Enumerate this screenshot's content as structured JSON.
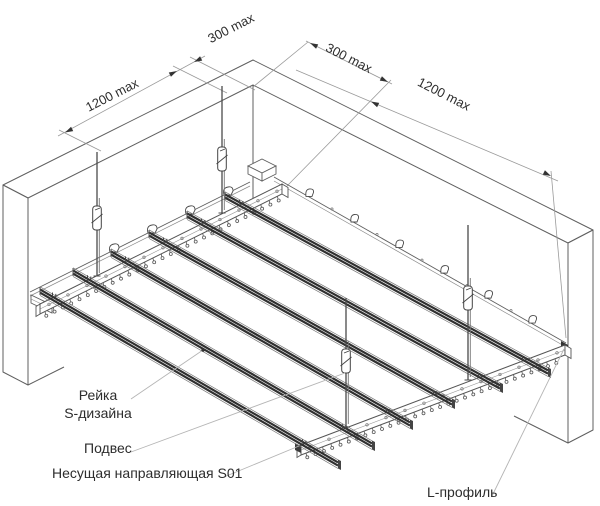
{
  "dimensions": {
    "left_span": "1200 max",
    "left_offset": "300 max",
    "right_offset": "300 max",
    "right_span": "1200 max"
  },
  "callouts": {
    "rail_line1": "Рейка",
    "rail_line2": "S-дизайна",
    "hanger": "Подвес",
    "carrier": "Несущая направляющая S01",
    "l_profile": "L-профиль"
  }
}
